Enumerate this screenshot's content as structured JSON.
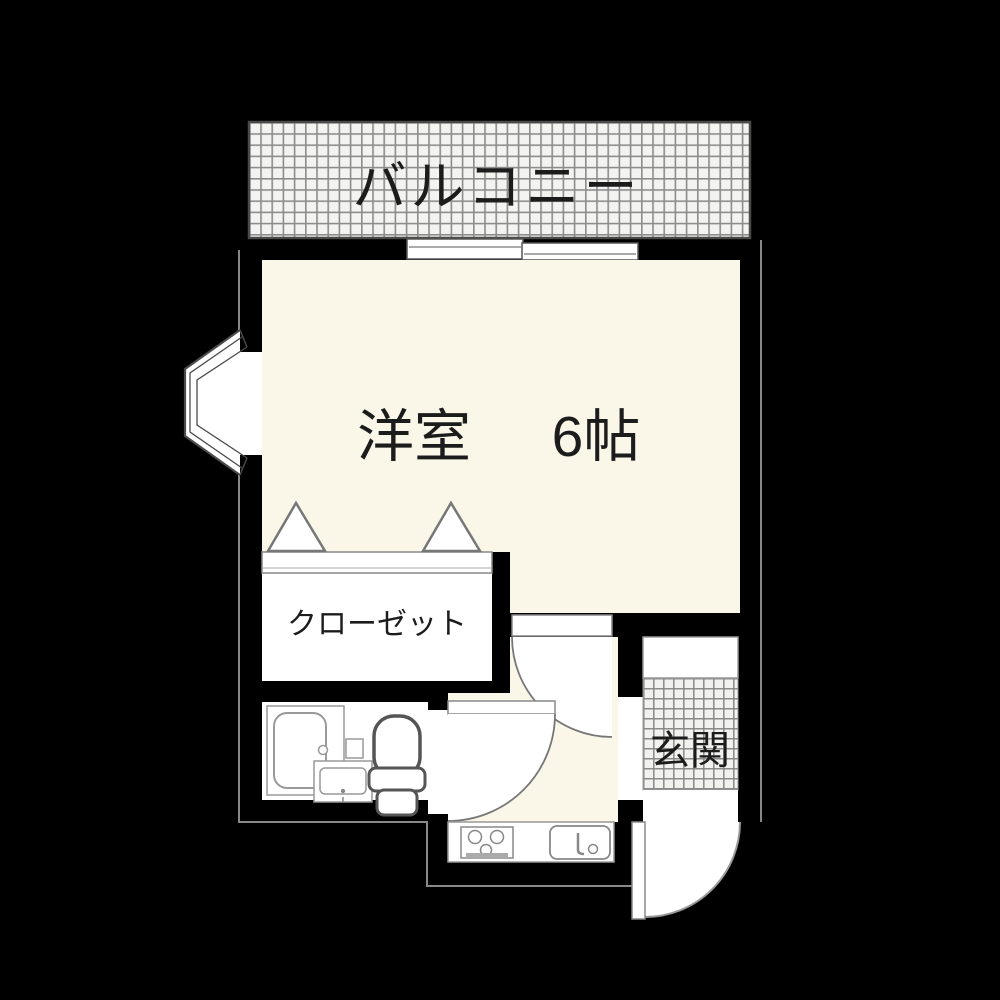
{
  "floorplan": {
    "background_color": "#000000",
    "floor_color": "#faf7e8",
    "room_fill_color": "#ffffff",
    "wall_color": "#000000",
    "hatch_background": "#f3f3f1",
    "hatch_line_color": "#8c8c8c",
    "outline_color": "#888888",
    "fixture_line_color": "#999999",
    "text_color": "#1c1c1c",
    "rooms": {
      "balcony": {
        "label": "バルコニー"
      },
      "western_room": {
        "label": "洋室",
        "size": "6帖"
      },
      "closet": {
        "label": "クローゼット"
      },
      "entrance": {
        "label": "玄関"
      }
    },
    "fixtures": [
      "bay-window",
      "sliding-window",
      "folding-closet-doors",
      "bathtub",
      "washbasin",
      "toilet",
      "kitchen-stove",
      "kitchen-sink",
      "hinged-doors"
    ]
  }
}
